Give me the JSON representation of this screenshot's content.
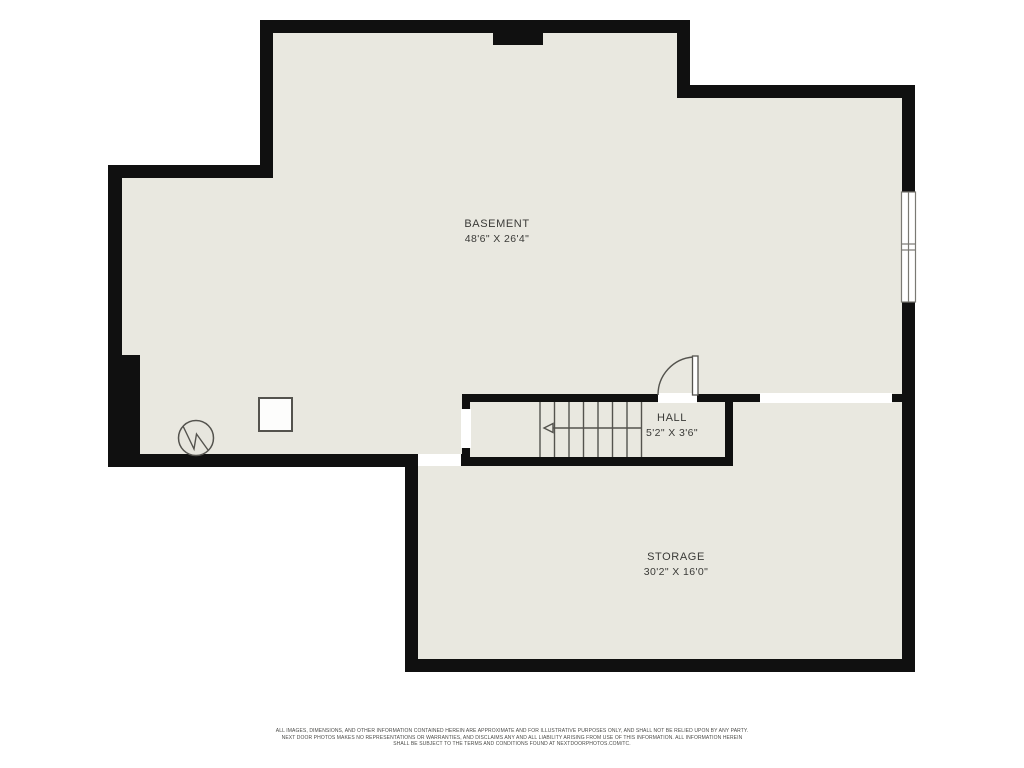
{
  "plan": {
    "rooms": [
      {
        "name": "BASEMENT",
        "dims": "48'6\" X 26'4\""
      },
      {
        "name": "HALL",
        "dims": "5'2\" X 3'6\""
      },
      {
        "name": "STORAGE",
        "dims": "30'2\" X 16'0\""
      }
    ],
    "icons": [
      "window-icon",
      "door-swing-icon",
      "stairs-icon",
      "stairs-direction-arrow-icon",
      "water-heater-icon",
      "furnace-icon",
      "chimney-icon"
    ],
    "colors": {
      "floor": "#e9e8e0",
      "wall": "#101010",
      "symbol_line": "#54534e",
      "text": "#3a3a37",
      "opening": "#ffffff"
    }
  },
  "footer": {
    "line1": "ALL IMAGES, DIMENSIONS, AND OTHER INFORMATION CONTAINED HEREIN ARE APPROXIMATE AND FOR ILLUSTRATIVE PURPOSES ONLY, AND SHALL NOT BE RELIED UPON BY ANY PARTY.",
    "line2": "NEXT DOOR PHOTOS MAKES NO REPRESENTATIONS OR WARRANTIES, AND DISCLAIMS ANY AND ALL LIABILITY ARISING FROM USE OF THIS INFORMATION. ALL INFORMATION HEREIN",
    "line3": "SHALL BE SUBJECT TO THE TERMS AND CONDITIONS FOUND AT NEXTDOORPHOTOS.COM/TC."
  }
}
